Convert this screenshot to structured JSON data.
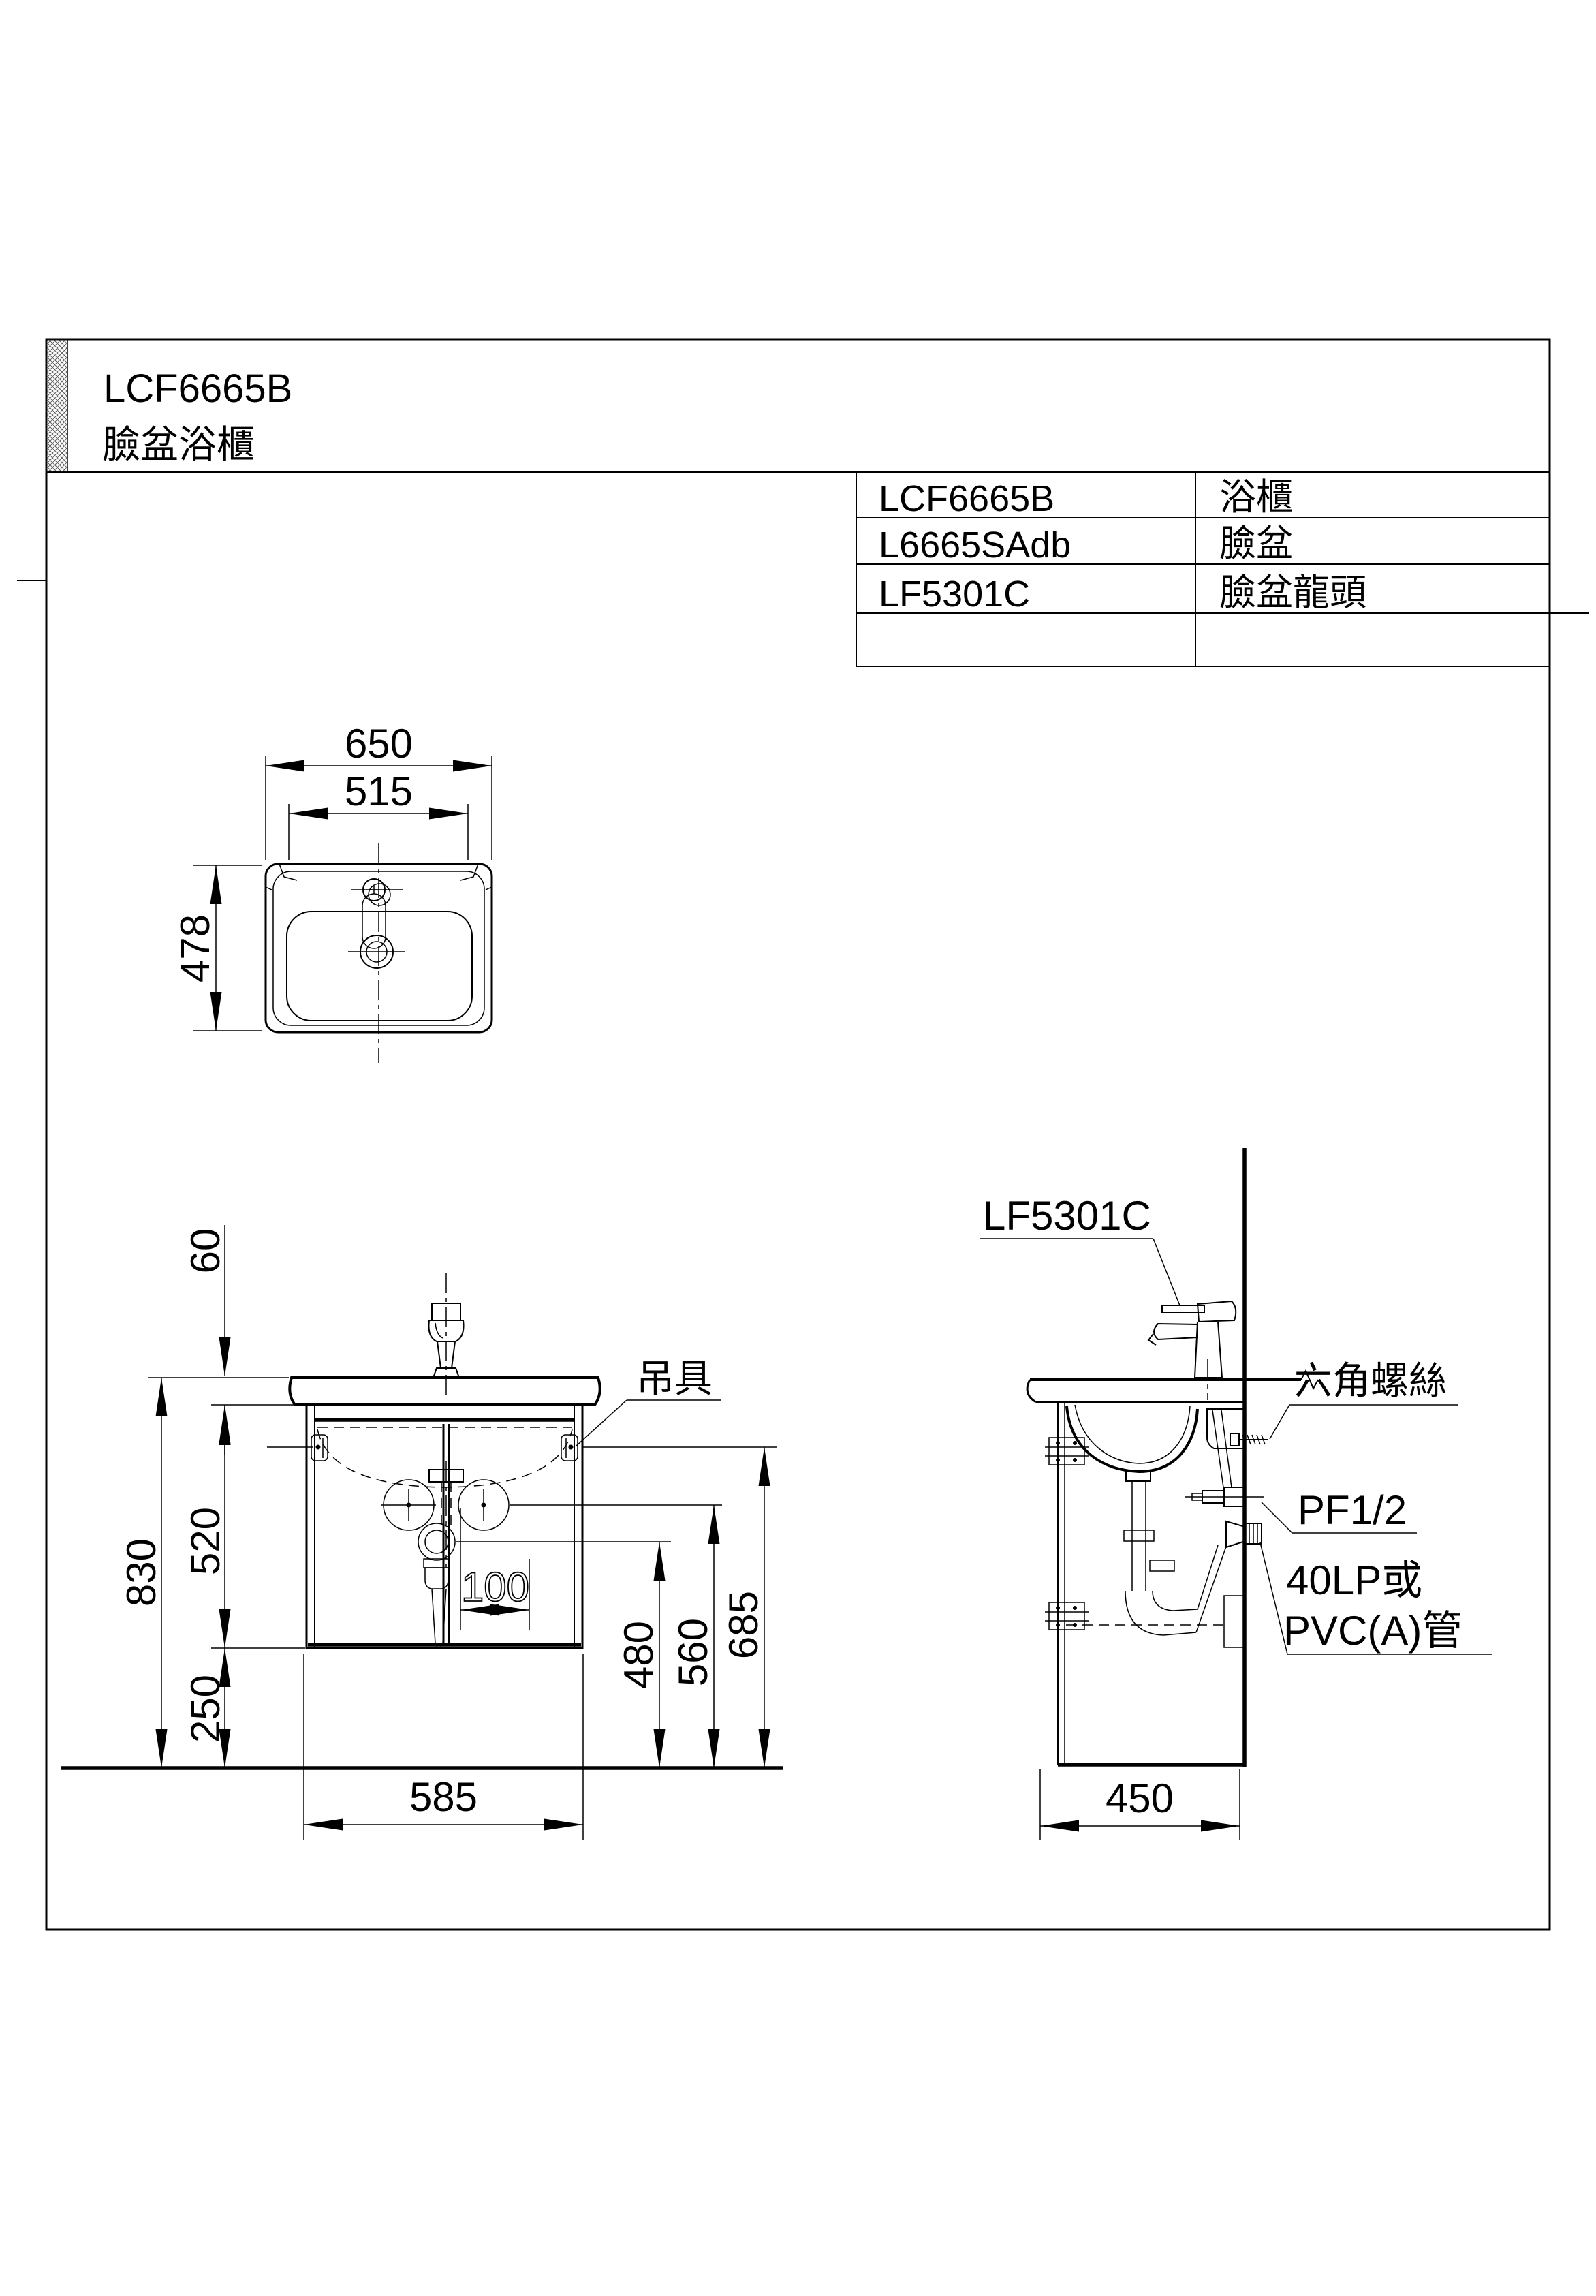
{
  "colors": {
    "line": "#000000",
    "background": "#ffffff",
    "hatch": "#555555"
  },
  "title_block": {
    "model": "LCF6665B",
    "product_name": "臉盆浴櫃"
  },
  "parts_table": {
    "rows": [
      {
        "code": "LCF6665B",
        "name": "浴櫃"
      },
      {
        "code": "L6665SAdb",
        "name": "臉盆"
      },
      {
        "code": "LF5301C",
        "name": "臉盆龍頭"
      },
      {
        "code": "",
        "name": ""
      }
    ]
  },
  "top_view": {
    "dims": {
      "width_overall": "650",
      "width_inner": "515",
      "depth": "478"
    }
  },
  "front_view": {
    "dims": {
      "ledge": "60",
      "total_height": "830",
      "cabinet_height": "520",
      "clearance": "250",
      "cabinet_width": "585",
      "drain_offset": "100",
      "drain_height": "480",
      "supply_height": "560",
      "hanger_height": "685"
    },
    "labels": {
      "hanger": "吊具"
    }
  },
  "side_view": {
    "dims": {
      "depth": "450"
    },
    "labels": {
      "faucet": "LF5301C",
      "hex_screw": "六角螺絲",
      "supply_thread": "PF1/2",
      "drain_pipe_line1": "40LP或",
      "drain_pipe_line2": "PVC(A)管"
    }
  }
}
